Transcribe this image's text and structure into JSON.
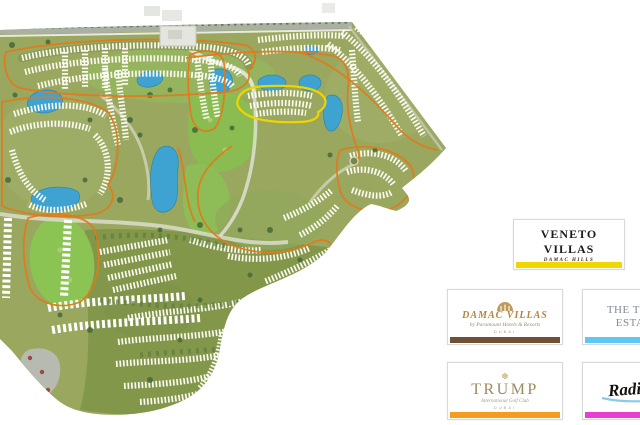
{
  "map": {
    "name": "master-plan community map",
    "colors": {
      "land": "#9aa75e",
      "golf_green": "#8cc454",
      "water": "#3fa3d2",
      "community_boundary": "#e2791a",
      "highlight_boundary": "#f0d400",
      "road": "#aab0a2",
      "houses": "#fbfbf3"
    }
  },
  "cards": {
    "veneto": {
      "title": "VENETO VILLAS",
      "subtitle": "DAMAC HILLS",
      "bar_color": "#f2d600"
    },
    "damac_villas": {
      "title": "DAMAC VILLAS",
      "subtitle": "by Paramount Hotels & Resorts",
      "footnote": "DUBAI",
      "bar_color": "#6e5134"
    },
    "trump_estates": {
      "title_line1": "THE TRUMP",
      "title_line2": "ESTATES",
      "bar_color": "#5ec8f2"
    },
    "trump": {
      "title": "TRUMP",
      "subtitle": "International Golf Club",
      "footnote": "DUBAI",
      "bar_color": "#f59b1e"
    },
    "radisson": {
      "title": "Radisson",
      "bar_color": "#e83fd0"
    }
  }
}
